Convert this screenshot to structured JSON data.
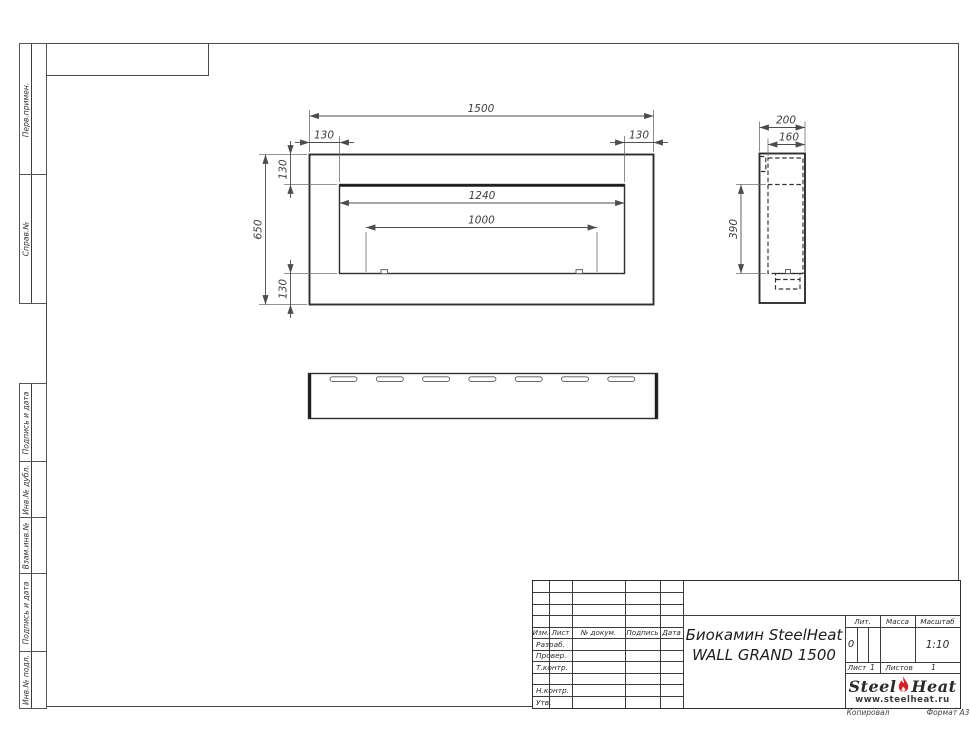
{
  "sheet": {
    "copied": "Копировал",
    "format": "Формат А3"
  },
  "sidebar": {
    "boxes": [
      {
        "label": "Перв.примен."
      },
      {
        "label": "Справ.№"
      },
      {
        "label": "Подпись и дата"
      },
      {
        "label": "Инв.№ дубл."
      },
      {
        "label": "Взам.инв.№"
      },
      {
        "label": "Подпись и дата"
      },
      {
        "label": "Инв.№ подл."
      }
    ]
  },
  "drawing": {
    "dims": {
      "front_width": "1500",
      "front_height": "650",
      "opening_width": "1240",
      "burner_width": "1000",
      "margin_left": "130",
      "margin_right": "130",
      "margin_top": "130",
      "margin_bottom": "130",
      "depth": "200",
      "inner_depth": "160",
      "opening_height": "390"
    }
  },
  "title_block": {
    "cols": {
      "izm": "Изм.",
      "list": "Лист",
      "doc": "№ докум.",
      "sign": "Подпись",
      "date": "Дата"
    },
    "rows": [
      {
        "label": "Разраб."
      },
      {
        "label": "Провер."
      },
      {
        "label": "Т.контр."
      },
      {
        "label": ""
      },
      {
        "label": "Н.контр."
      },
      {
        "label": "Утв."
      }
    ],
    "title_line1": "Биокамин SteelHeat",
    "title_line2": "WALL GRAND 1500",
    "lit_label": "Лит.",
    "lit_value": "0",
    "mass_label": "Масса",
    "scale_label": "Масштаб",
    "scale_value": "1:10",
    "sheet_label": "Лист",
    "sheet_value": "1",
    "sheets_label": "Листов",
    "sheets_value": "1",
    "logo": {
      "brand1": "Steel",
      "brand2": "Heat",
      "url": "www.steelheat.ru",
      "flame_color": "#d2232a"
    }
  }
}
